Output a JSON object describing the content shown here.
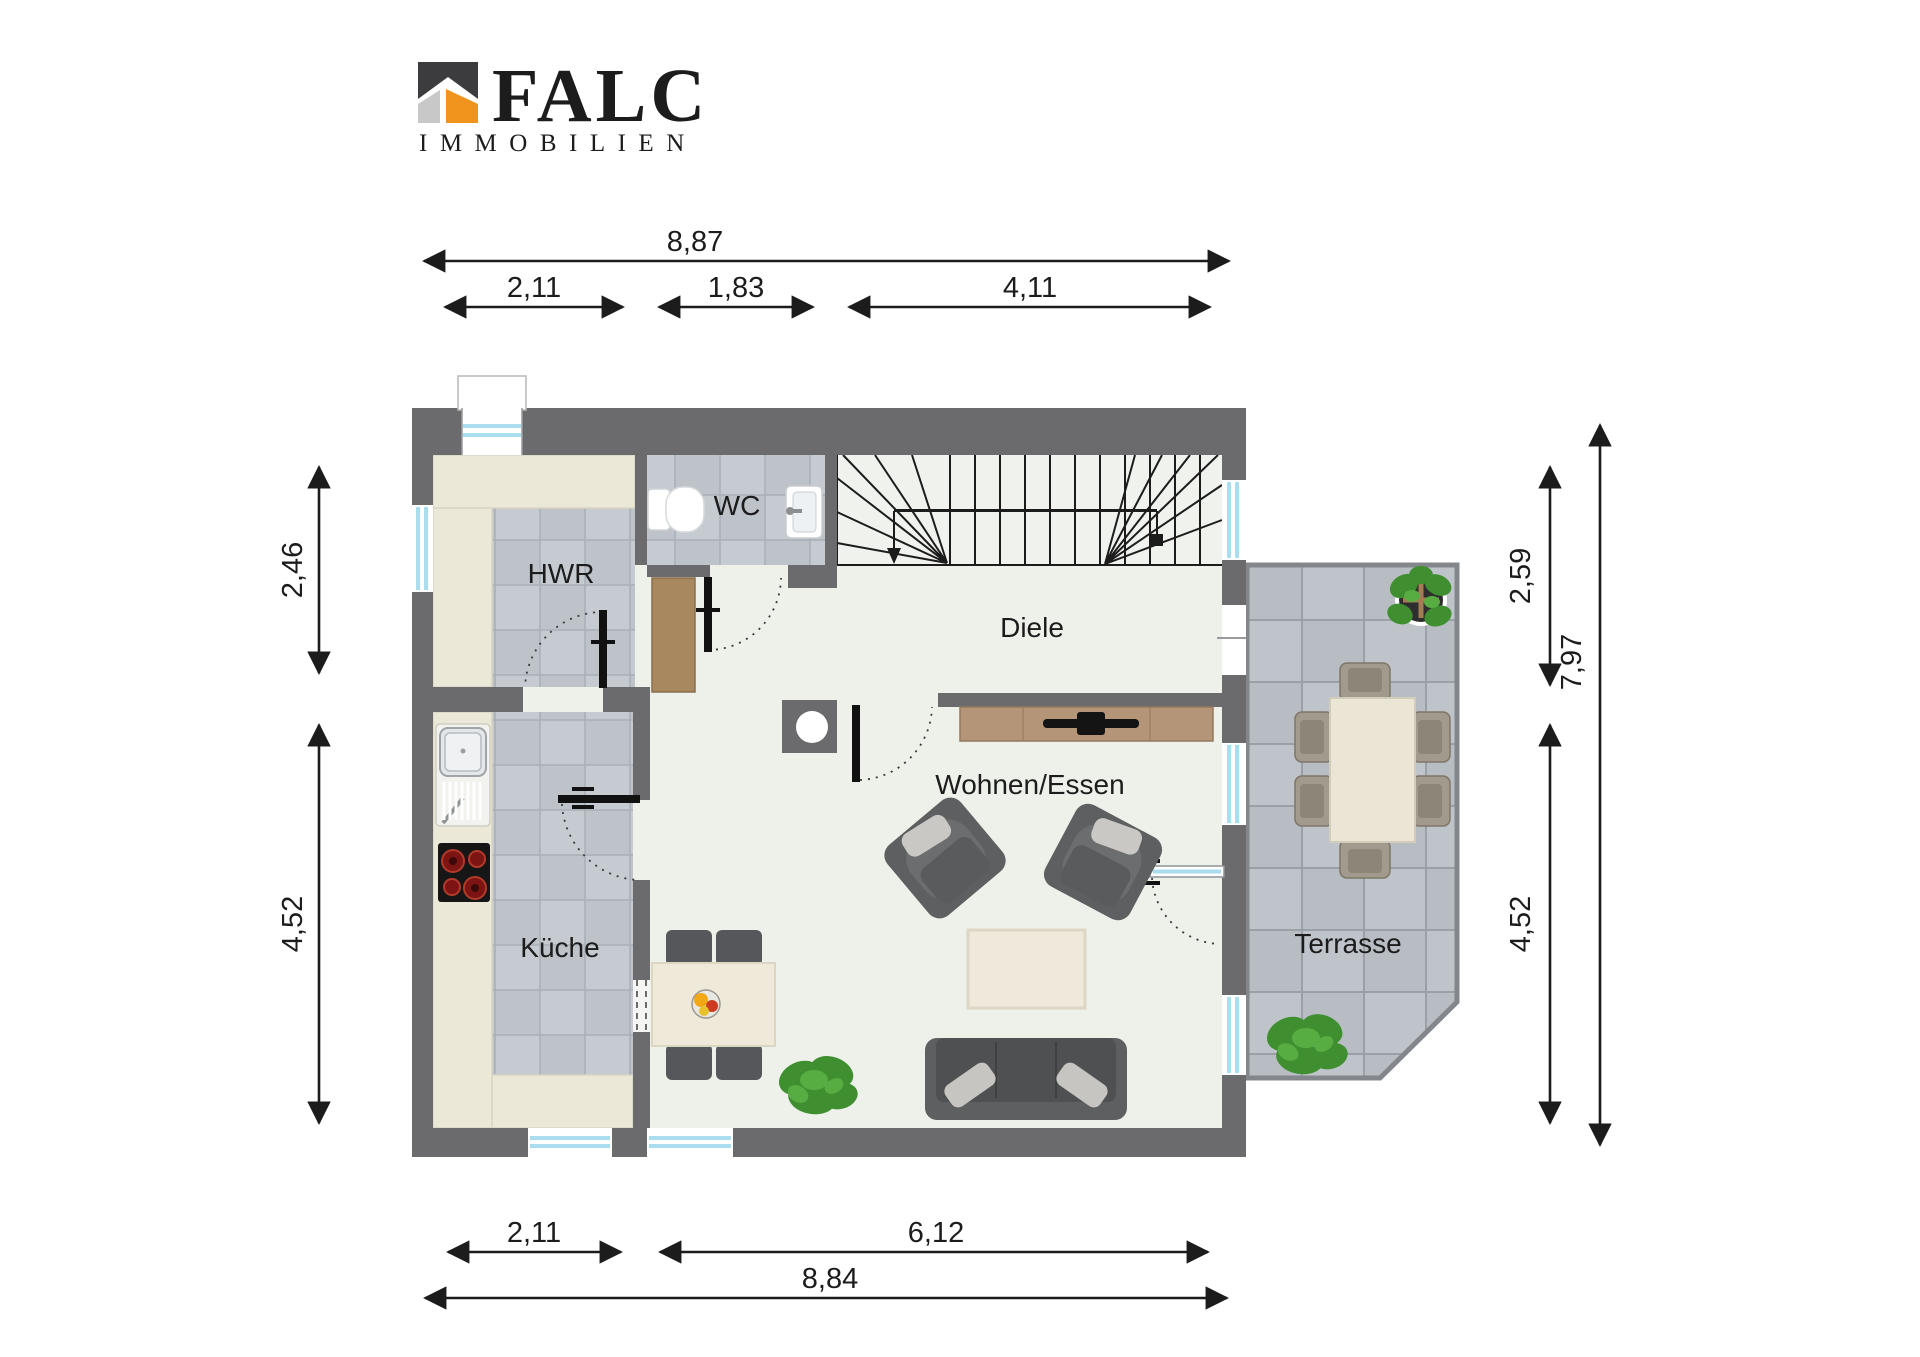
{
  "logo": {
    "name": "FALC",
    "subtitle": "IMMOBILIEN"
  },
  "rooms": {
    "hwr": "HWR",
    "wc": "WC",
    "diele": "Diele",
    "kueche": "Küche",
    "wohnen_essen": "Wohnen/Essen",
    "terrasse": "Terrasse"
  },
  "dimensions": {
    "top_total": "8,87",
    "top_seg1": "2,11",
    "top_seg2": "1,83",
    "top_seg3": "4,11",
    "left_upper": "2,46",
    "left_lower": "4,52",
    "right_upper": "2,59",
    "right_lower": "4,52",
    "right_total": "7,97",
    "bottom_seg1": "2,11",
    "bottom_seg2": "6,12",
    "bottom_total": "8,84"
  },
  "colors": {
    "wall": "#6b6b6d",
    "floor": "#eef0ea",
    "accent_orange": "#f0941e",
    "glass": "#aadeee",
    "plant_green": "#4c9c38"
  }
}
